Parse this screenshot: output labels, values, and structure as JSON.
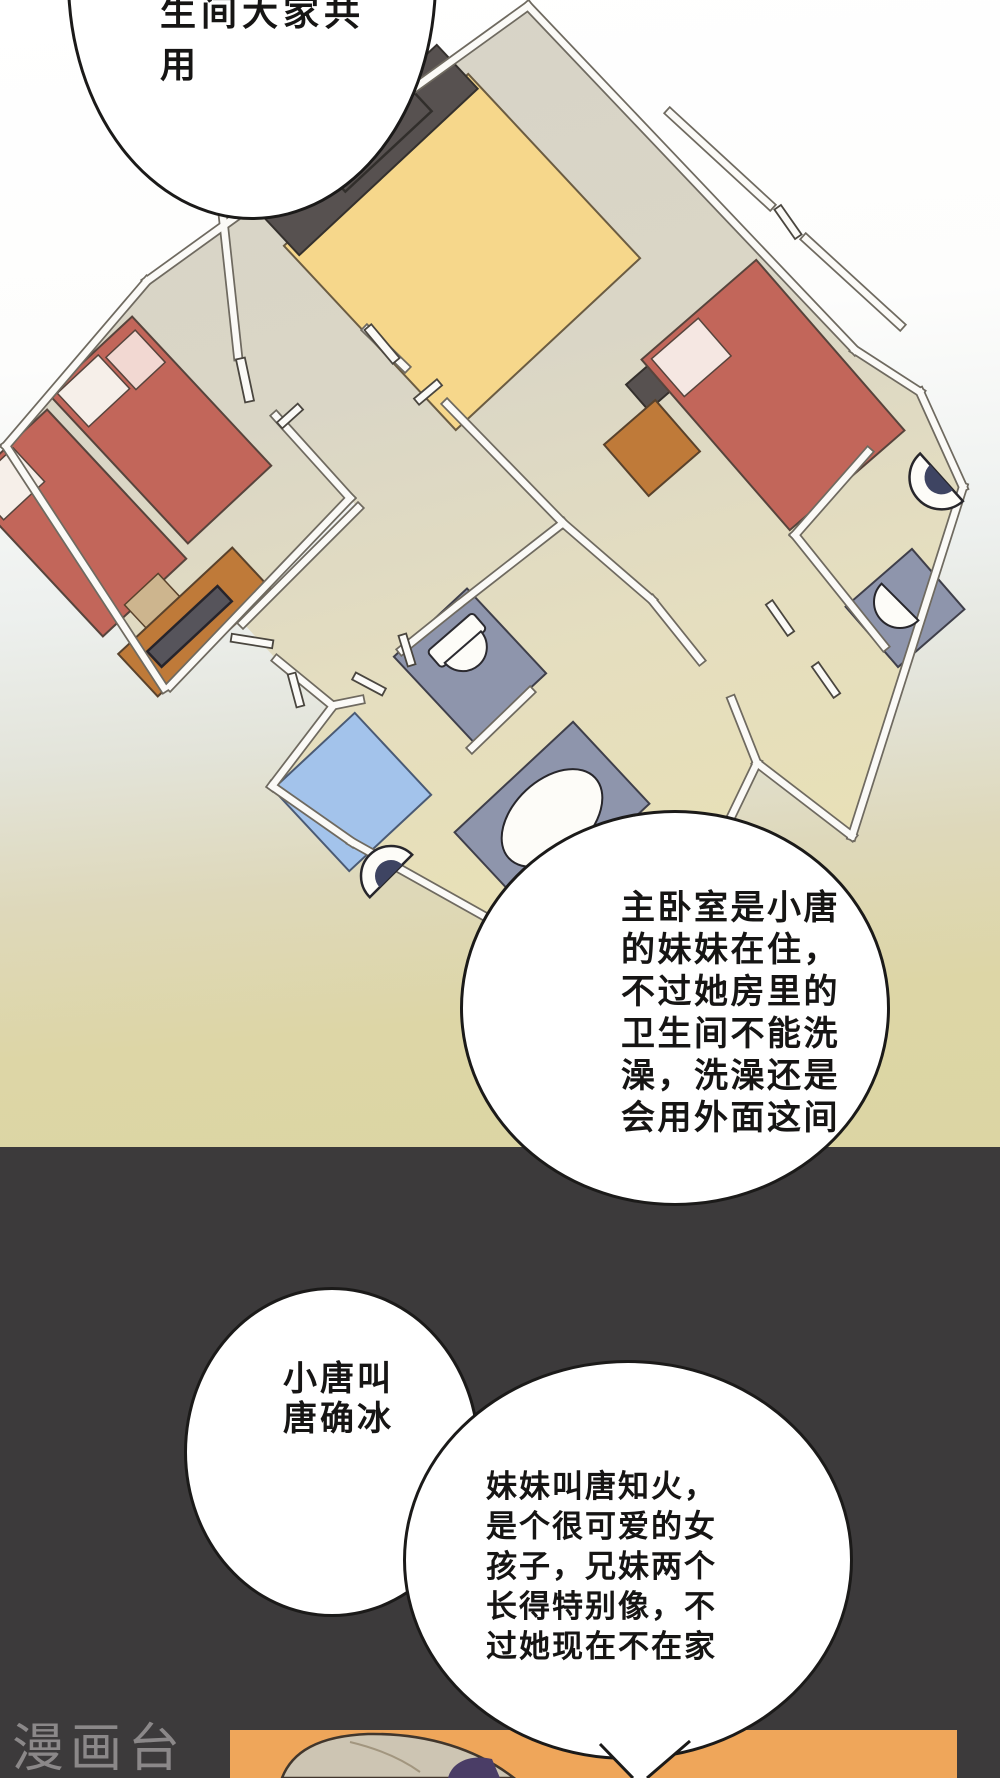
{
  "page": {
    "width": 1000,
    "height": 1778,
    "kind": "manhua comic page"
  },
  "panels": {
    "floorplan_panel": {
      "background_top": "#ffffff",
      "background_bottom": "#dcd5a3"
    },
    "dark_panel": {
      "background": "#3c3a3b"
    },
    "photo_panel": {
      "background": "#efa65a"
    }
  },
  "speech_bubbles": [
    {
      "id": "bubble-shared-bathroom",
      "text": "生间大家共\n用"
    },
    {
      "id": "bubble-master-bedroom",
      "text": "主卧室是小唐\n的妹妹在住，\n不过她房里的\n卫生间不能洗\n澡，洗澡还是\n会用外面这间"
    },
    {
      "id": "bubble-brother-name",
      "text": "小唐叫\n唐确冰"
    },
    {
      "id": "bubble-sister-intro",
      "text": "妹妹叫唐知火，\n是个很可爱的女\n孩子，兄妹两个\n长得特别像，不\n过她现在不在家"
    }
  ],
  "watermark": {
    "text": "漫画台",
    "color": "#8b8889"
  },
  "floorplan": {
    "description": "rotated apartment floor plan",
    "colors": {
      "floor_light": "#d8d4c8",
      "floor_warm": "#e7dfbe",
      "wall_fill": "#fbfaf7",
      "wall_outline": "#6f6a60",
      "master_bed": "#f6d78b",
      "dark_furniture": "#575150",
      "red_bed": "#c2665a",
      "pillow_white": "#f6efe9",
      "pillow_pink": "#f2d8d2",
      "orange_furniture": "#bf7a39",
      "tan_box": "#cdb58e",
      "fixture_gray": "#8e95ac",
      "fixture_white": "#fdfcf8",
      "fixture_navy": "#3e4462",
      "shower_blue": "#a3c3eb"
    },
    "items": [
      "master-bed",
      "headboard",
      "single-bed-a",
      "single-bed-b",
      "dresser",
      "phone-on-dresser",
      "tan-box",
      "right-bed",
      "tv-stand",
      "nightstand",
      "shower-square",
      "bathtub",
      "sink-unit",
      "toilet-square",
      "corner-sink",
      "corner-toilet",
      "door-leaves",
      "walls"
    ]
  },
  "character": {
    "hair_color": "#cdc5b3",
    "shade_color": "#4a3d66"
  }
}
